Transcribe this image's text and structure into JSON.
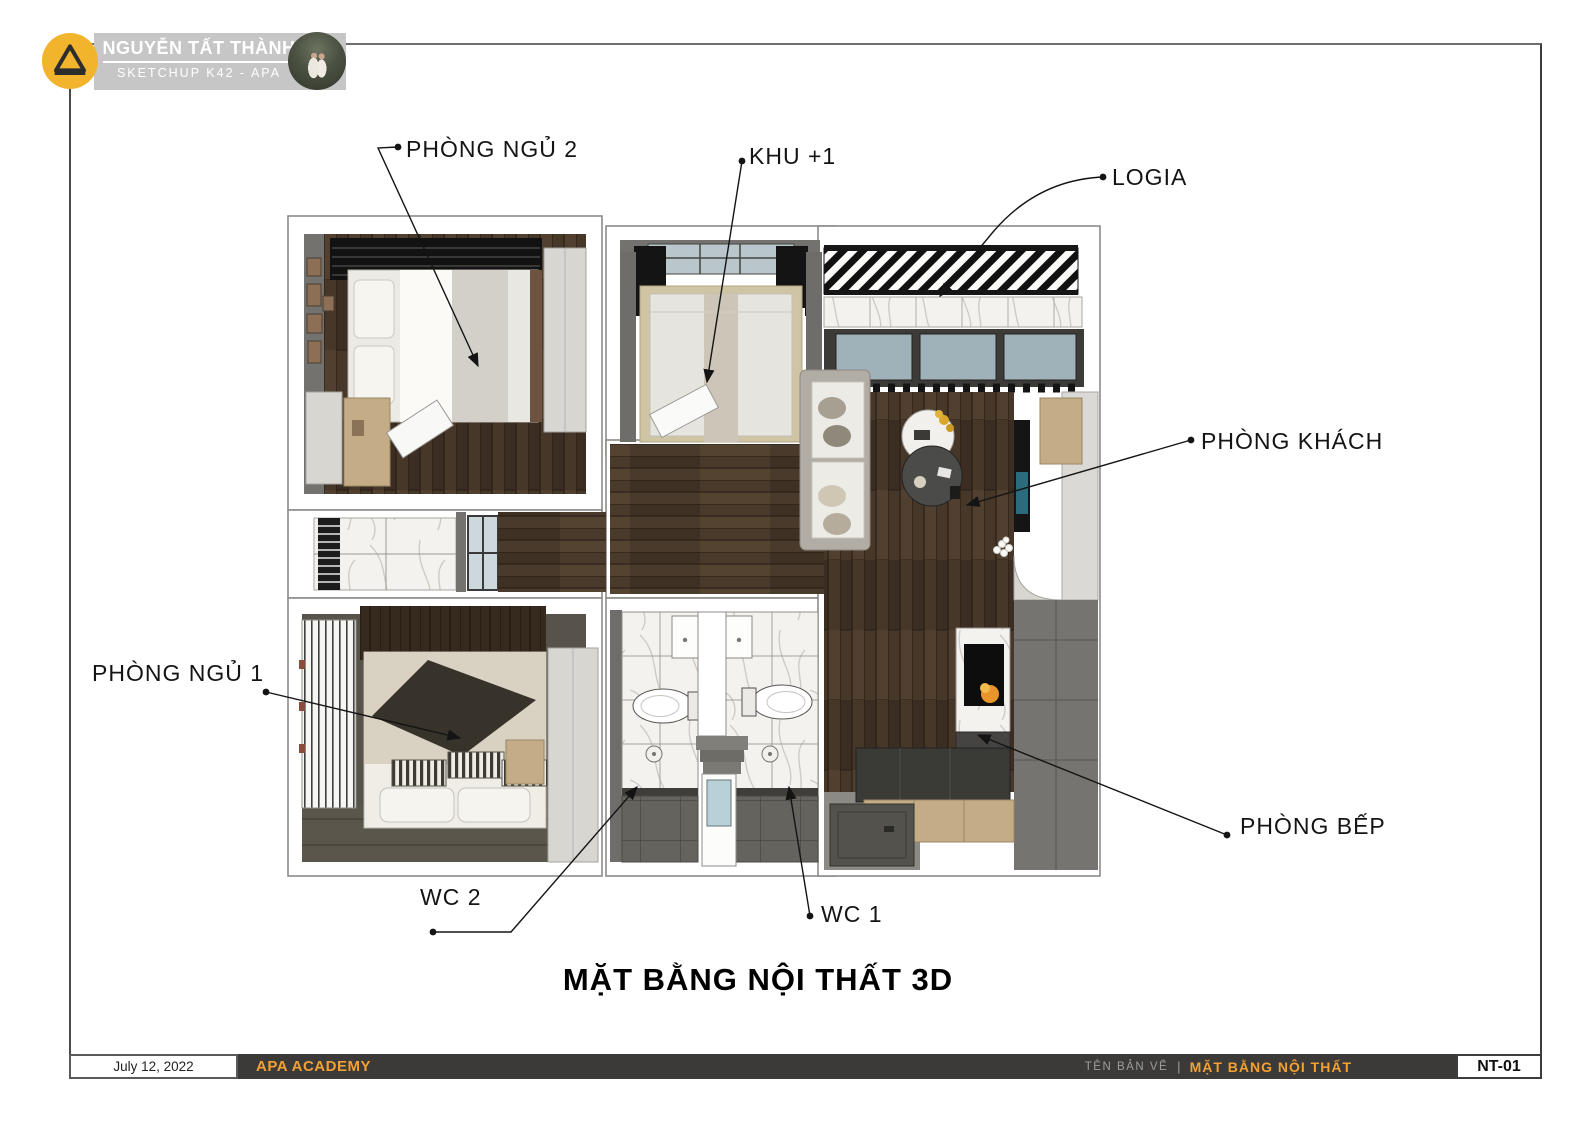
{
  "header": {
    "title": "NGUYỄN TẤT THÀNH",
    "subtitle": "SKETCHUP K42 - APA",
    "logo": "apa-triangle-icon",
    "avatar": "instructor-photo"
  },
  "plan": {
    "title": "MẶT BẰNG NỘI THẤT 3D",
    "labels": [
      {
        "text": "PHÒNG NGỦ 2",
        "target": "bedroom-2"
      },
      {
        "text": "KHU +1",
        "target": "khu-plus-1"
      },
      {
        "text": "LOGIA",
        "target": "logia"
      },
      {
        "text": "PHÒNG KHÁCH",
        "target": "living-room"
      },
      {
        "text": "PHÒNG NGỦ 1",
        "target": "bedroom-1"
      },
      {
        "text": "PHÒNG BẾP",
        "target": "kitchen"
      },
      {
        "text": "WC 2",
        "target": "wc-2"
      },
      {
        "text": "WC 1",
        "target": "wc-1"
      }
    ]
  },
  "titleblock": {
    "date": "July 12, 2022",
    "company": "APA ACADEMY",
    "drawing_name_label": "TÊN BẢN VẼ",
    "separator": "|",
    "drawing_name": "MẶT BẰNG NỘI THẤT",
    "sheet_no": "NT-01",
    "accent_color": "#F2A132"
  }
}
